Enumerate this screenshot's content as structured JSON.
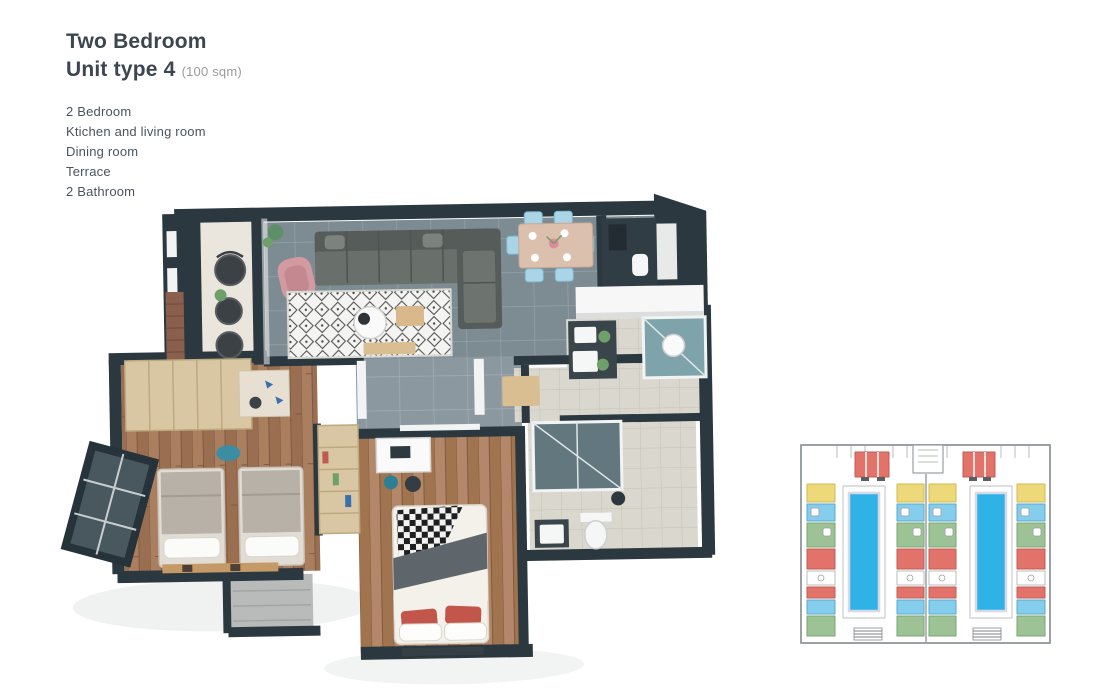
{
  "page": {
    "background": "#ffffff"
  },
  "header": {
    "title_line1": "Two Bedroom",
    "title_line2": "Unit type 4",
    "area_note": "(100 sqm)",
    "title_color": "#3d4650",
    "area_color": "#9b9b9b"
  },
  "features": {
    "items": [
      "2 Bedroom",
      "Ktichen and living room",
      "Dining room",
      "Terrace",
      "2 Bathroom"
    ],
    "text_color": "#4a545e"
  },
  "floor_plan": {
    "name": "floor-plan-3d-render",
    "colors": {
      "walls": "#2b3840",
      "tile_floor": "#7d8b93",
      "wood_floor": "#a57a5c",
      "terrace_floor": "#eae6dd",
      "bath_floor": "#dad7ce",
      "sofa": "#5f6562",
      "rug": "#f4f4f2",
      "accent_chair": "#d49aa2",
      "dining_chairs": "#a9d5e7",
      "bed_pillow_red": "#c3564b",
      "wardrobe_wood": "#d9c7a4"
    }
  },
  "key_plan": {
    "name": "building-key-plan",
    "colors": {
      "outline": "#9aa0a3",
      "pool": "#2fb2e5",
      "unit_red": "#e2736b",
      "unit_yellow": "#edd87a",
      "unit_blue": "#85cdec",
      "unit_green": "#9dc295"
    }
  }
}
